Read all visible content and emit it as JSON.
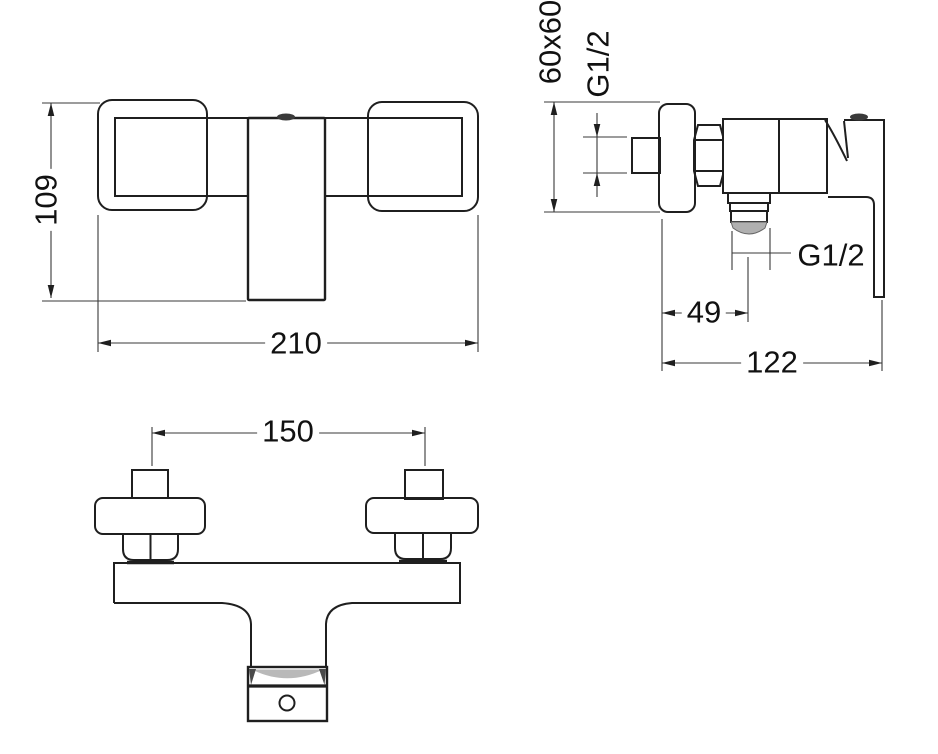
{
  "drawing": {
    "type": "technical-drawing",
    "subject": "Wall-mounted shower mixer tap, three orthographic views with dimensions",
    "units": "mm",
    "front_view": {
      "height_dim": "109",
      "width_dim": "210"
    },
    "side_view": {
      "escutcheon_dim": "60x60",
      "inlet_thread": "G1/2",
      "outlet_thread": "G1/2",
      "outlet_offset_dim": "49",
      "depth_dim": "122"
    },
    "top_view": {
      "connection_centers_dim": "150"
    },
    "colors": {
      "object_line": "#1f1f1f",
      "dimension_line": "#3a3a3a",
      "shading_gray": "#b0b0b0",
      "background": "#ffffff"
    }
  }
}
